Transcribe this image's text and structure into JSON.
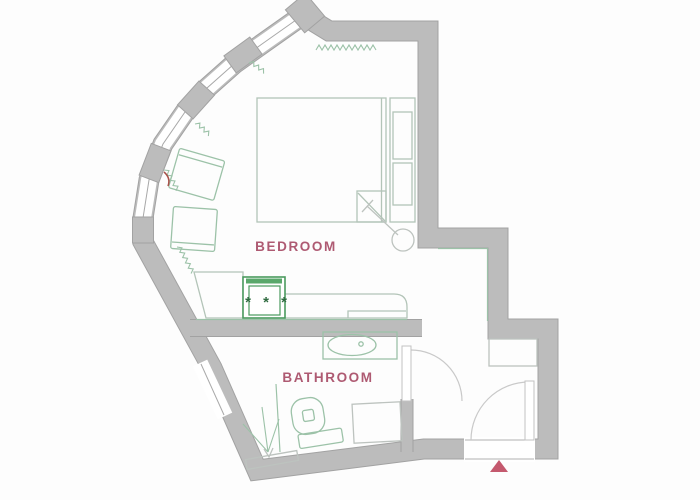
{
  "plan": {
    "type": "apartment-floor-plan",
    "rooms": [
      {
        "name": "bedroom",
        "label": "BEDROOM"
      },
      {
        "name": "bathroom",
        "label": "BATHROOM"
      }
    ],
    "kitchen": {
      "stove_burners": "* * *"
    },
    "fixtures": [
      "double-bed",
      "nightstand-shelves",
      "floor-lamp",
      "armchair",
      "armchair",
      "kitchen-counter",
      "stove",
      "bathroom-sink",
      "toilet",
      "shower",
      "washing-machine",
      "hallway-closet",
      "entrance-door",
      "bathroom-door",
      "curved-window-wall"
    ],
    "colors": {
      "wall": "#bcbcbc",
      "wall_edge": "#a2a2a2",
      "furniture_green": "#9cc2a8",
      "door_gray": "#c9c9c9",
      "room_label": "#ae5a72",
      "stove_burners": "#2f6b40",
      "stove_frame": "#4a9a5e",
      "entrance_marker": "#c4596e"
    }
  }
}
